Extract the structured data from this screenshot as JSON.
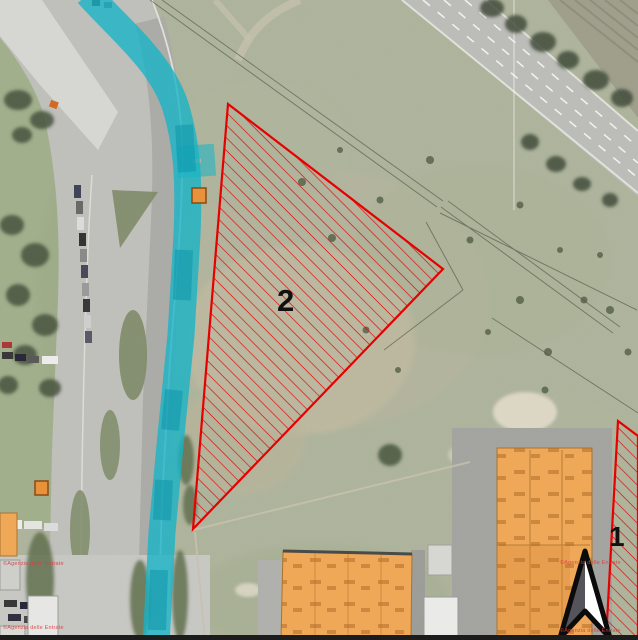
{
  "map_overlay": {
    "parcels": [
      {
        "id": 2,
        "label": "2"
      },
      {
        "id": 1,
        "label": "1"
      }
    ],
    "watermark_text": "©Agenzia delle Entrate",
    "north_arrow_icon": "north-arrow",
    "legend_colors": {
      "parcel_hatch_red": "#e60000",
      "canal_highlight_teal": "#14b4c6",
      "canal_highlight_teal_dark": "#0e95aa",
      "building_highlight_orange": "#efa758",
      "building_outline_orange": "#a9742e",
      "marker_orange": "#e8933c",
      "watermark_red": "#d94040",
      "label_black": "#111111",
      "frame_bar_black": "#1c1c1c"
    }
  }
}
